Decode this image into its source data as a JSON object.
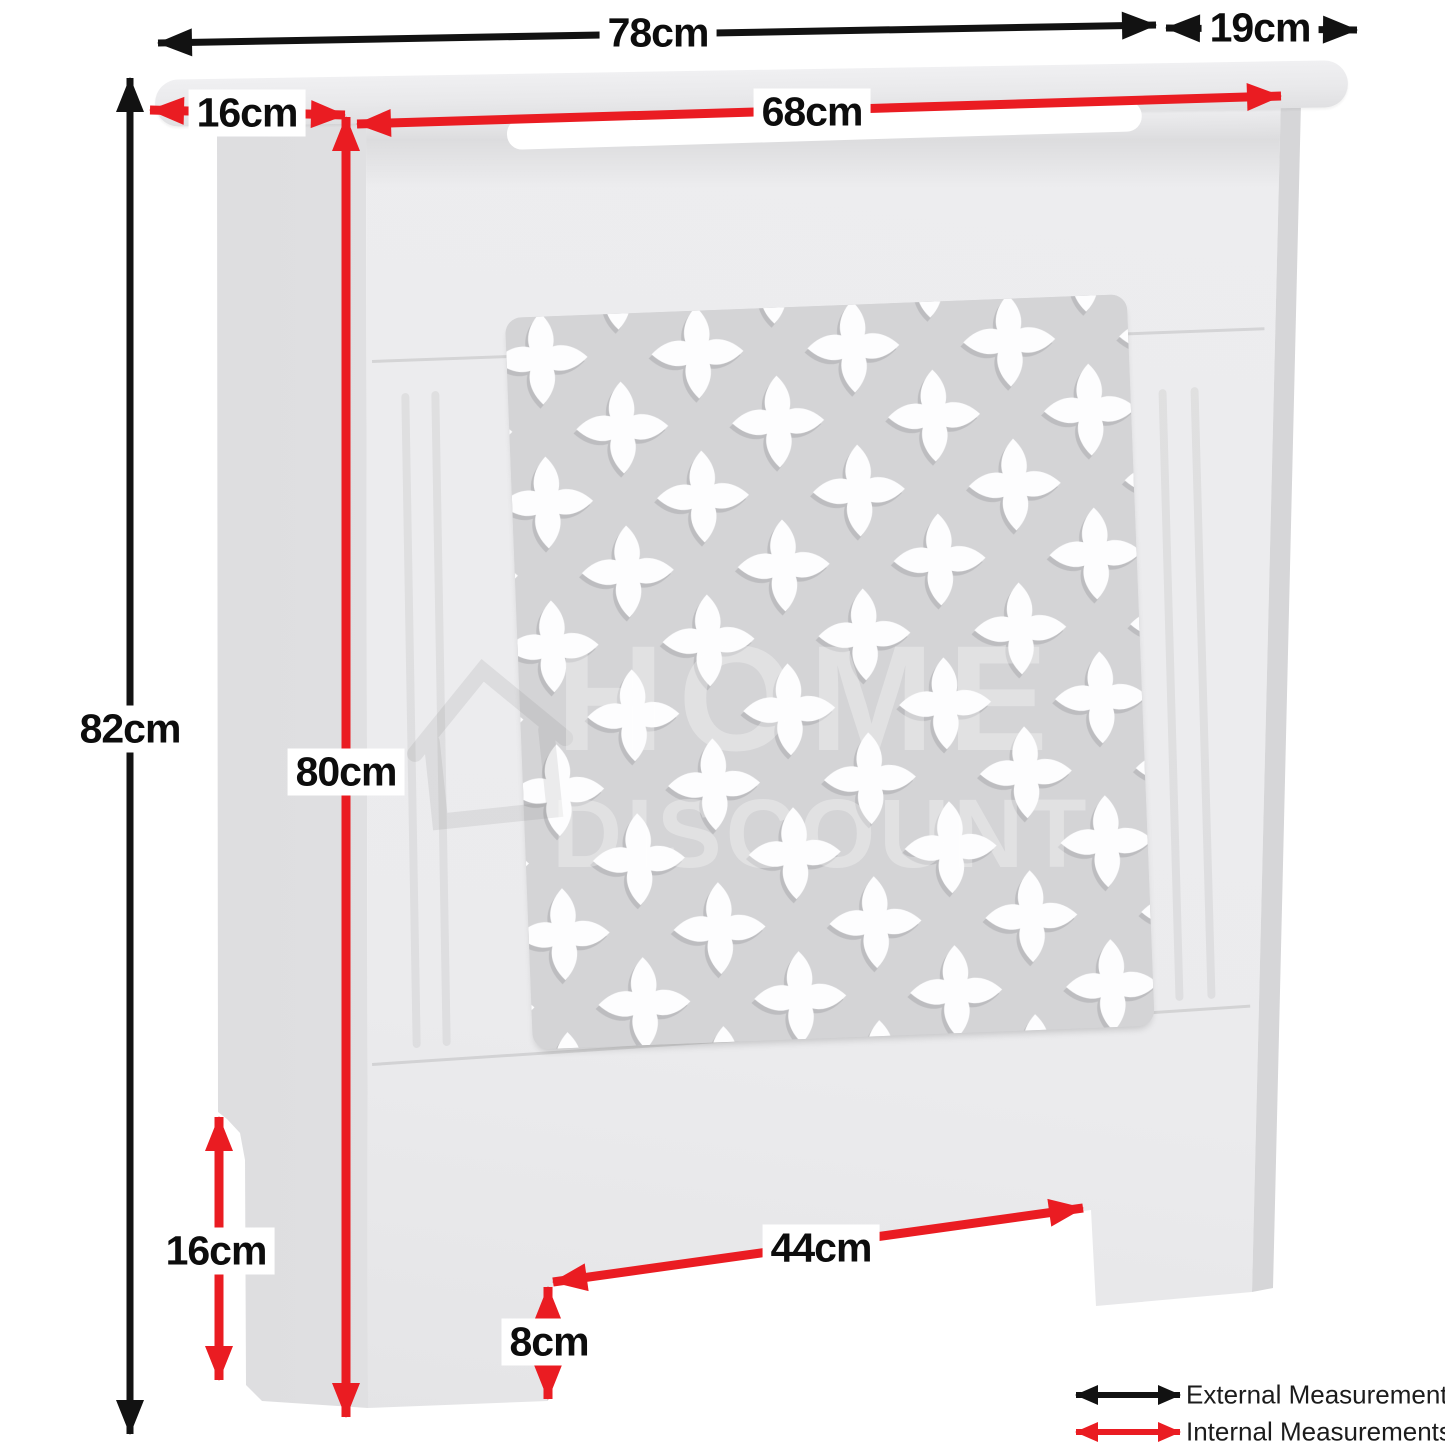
{
  "measurements": {
    "external": {
      "width": "78cm",
      "depth": "19cm",
      "height": "82cm"
    },
    "internal": {
      "width": "68cm",
      "top_depth": "16cm",
      "height": "80cm",
      "side_leg_height": "16cm",
      "bottom_opening_width": "44cm",
      "bottom_opening_height": "8cm"
    }
  },
  "legend": {
    "external": {
      "label": "External Measurements",
      "color": "#121212"
    },
    "internal": {
      "label": "Internal Measurements",
      "color": "#ea1c22"
    }
  },
  "watermark": {
    "word1": "HOME",
    "word2": "DISCOUNT"
  },
  "colors": {
    "background": "#ffffff",
    "cabinet_body": "#eaeaec",
    "cabinet_side": "#e0e0e2",
    "grille_background": "#d4d4d6",
    "grille_cutouts": "#fdfdfe",
    "external_arrow": "#121212",
    "internal_arrow": "#ea1c22"
  }
}
